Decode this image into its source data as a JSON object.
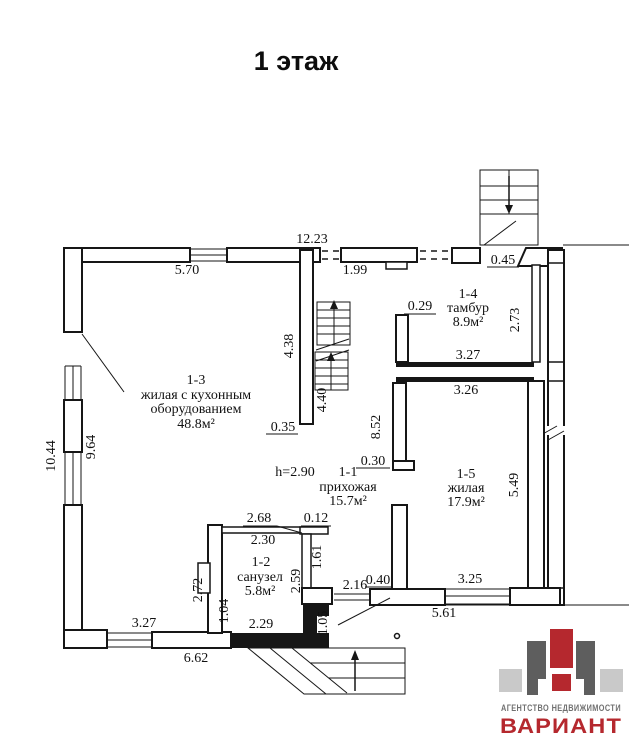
{
  "page": {
    "title": "1 этаж"
  },
  "plan": {
    "height_note": "h=2.90",
    "rooms": {
      "r13": {
        "l1": "1-3",
        "l2": "жилая с кухонным",
        "l3": "оборудованием",
        "l4": "48.8м²"
      },
      "r14": {
        "l1": "1-4",
        "l2": "тамбур",
        "l3": "8.9м²"
      },
      "r11": {
        "l1": "1-1",
        "l2": "прихожая",
        "l3": "15.7м²"
      },
      "r15": {
        "l1": "1-5",
        "l2": "жилая",
        "l3": "17.9м²"
      },
      "r12": {
        "l1": "1-2",
        "l2": "санузел",
        "l3": "5.8м²"
      }
    },
    "dims": {
      "d12_23": "12.23",
      "d5_70": "5.70",
      "d1_99": "1.99",
      "d0_45": "0.45",
      "d2_73": "2.73",
      "d0_29": "0.29",
      "d3_27a": "3.27",
      "d3_26": "3.26",
      "d8_52": "8.52",
      "d4_38": "4.38",
      "d4_40": "4.40",
      "d0_35": "0.35",
      "d0_30": "0.30",
      "d5_49": "5.49",
      "d10_44": "10.44",
      "d9_64": "9.64",
      "d2_68": "2.68",
      "d0_12": "0.12",
      "d2_30": "2.30",
      "d1_61": "1.61",
      "d2_72": "2.72",
      "d2_59": "2.59",
      "d2_16": "2.16",
      "d0_40": "0.40",
      "d1_04": "1.04",
      "d1_05": "1.05",
      "d2_29": "2.29",
      "d3_25": "3.25",
      "d5_61": "5.61",
      "d3_27b": "3.27",
      "d6_62": "6.62"
    }
  },
  "logo": {
    "line1": "АГЕНТСТВО НЕДВИЖИМОСТИ",
    "line2": "ВАРИАНТ",
    "colors": {
      "red": "#b5282e",
      "dark": "#5e5e5e",
      "light": "#c9c9c9",
      "text_gray": "#707070"
    }
  }
}
